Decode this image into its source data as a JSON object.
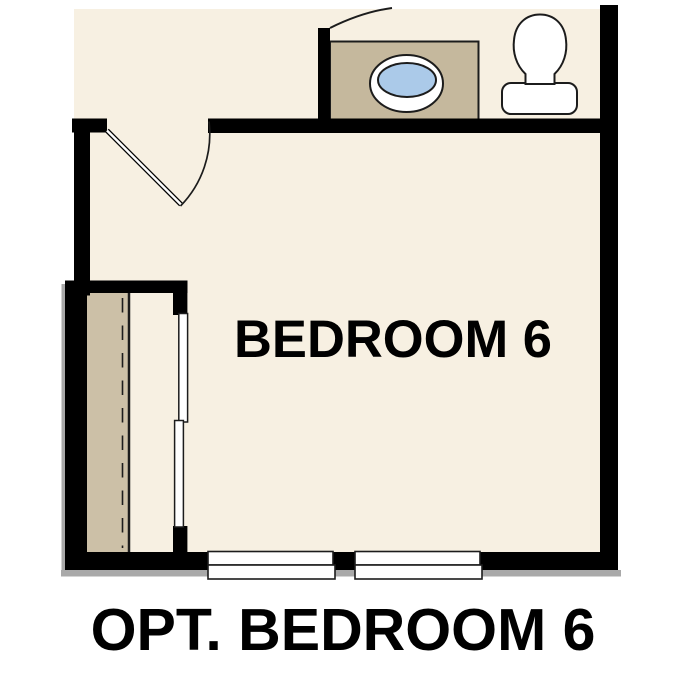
{
  "plan": {
    "room_label": "BEDROOM 6",
    "caption": "OPT. BEDROOM 6"
  },
  "fixtures": {
    "sink": "oval drop-in sink on vanity counter",
    "toilet": "toilet with tank",
    "closet": "closet with bypass sliding doors",
    "door": "hinged door with swing arc",
    "windows": "two windows on bottom wall"
  },
  "colors": {
    "background": "#ffffff",
    "floor": "#f7f0e2",
    "wall": "#000000",
    "line": "#1c1c1c",
    "counter": "#c5b89d",
    "closet_floor": "#ccc0a7",
    "sink_basin": "#abcae9",
    "fixture_fill": "#ffffff",
    "shadow": "#a9a9a9",
    "text": "#000000"
  }
}
